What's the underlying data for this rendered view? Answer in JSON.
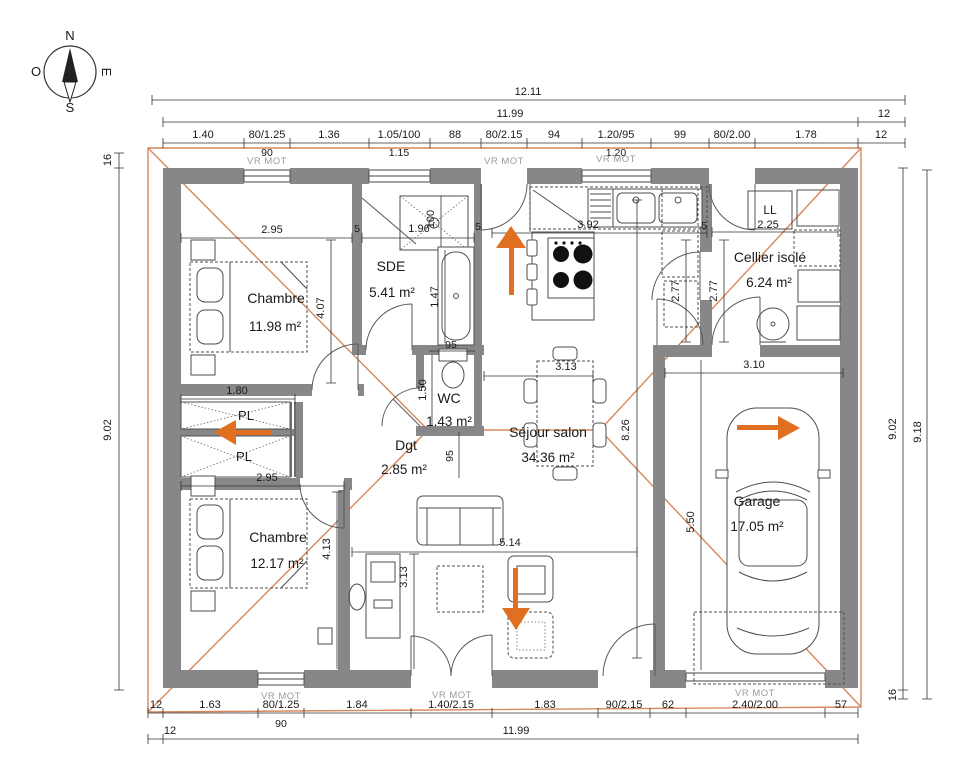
{
  "colors": {
    "wall": "#878787",
    "roof_line": "#D8875C",
    "arrow": "#E0701F",
    "dim_text": "#1a1a1a",
    "shutter_text": "#9b9b9b"
  },
  "compass": {
    "north": "N",
    "south": "S",
    "east": "E",
    "west": "O"
  },
  "top_dims": {
    "total": "12.11",
    "row2_main": "11.99",
    "row2_right": "12",
    "row3": [
      "1.40",
      "80/1.25",
      "1.36",
      "1.05/100",
      "88",
      "80/2.15",
      "94",
      "1.20/95",
      "99",
      "80/2.00",
      "1.78",
      "12"
    ],
    "row4": [
      "90",
      "1.15",
      "1.20"
    ]
  },
  "left_dims": {
    "overhang": "16",
    "height": "9.02"
  },
  "right_dims": {
    "inner": "9.02",
    "outer": "9.18",
    "overhang": "16"
  },
  "bottom_dims": {
    "row1": [
      "12",
      "1.63",
      "80/1.25",
      "1.84",
      "1.40/2.15",
      "1.83",
      "90/2.15",
      "62",
      "2.40/2.00",
      "57"
    ],
    "row1_sub": "90",
    "row2_left": "12",
    "row2_main": "11.99"
  },
  "shutter_labels": [
    "VR MOT",
    "VR MOT",
    "VR MOT",
    "VR MOT",
    "VR MOT",
    "VR MOT"
  ],
  "rooms": {
    "chambre1": {
      "name": "Chambre",
      "area": "11.98 m²"
    },
    "sde": {
      "name": "SDE",
      "area": "5.41 m²"
    },
    "wc": {
      "name": "WC",
      "area": "1.43 m²"
    },
    "dgt": {
      "name": "Dgt",
      "area": "2.85 m²"
    },
    "sejour": {
      "name": "Séjour salon",
      "area": "34.36 m²"
    },
    "cellier": {
      "name": "Cellier isolé",
      "area": "6.24 m²"
    },
    "chambre2": {
      "name": "Chambre",
      "area": "12.17 m²"
    },
    "garage": {
      "name": "Garage",
      "area": "17.05 m²"
    }
  },
  "fixtures": {
    "closet1": "PL",
    "closet2": "PL",
    "washer": "LL"
  },
  "interior_dims": {
    "chambre1_w": "2.95",
    "chambre1_h": "4.07",
    "shower_w": "1.96",
    "shower_d": "100",
    "wall5_a": "5",
    "wall5_b": "5",
    "wall5_c": "5",
    "kitchen_w": "3.92",
    "cellier_d1": "2.77",
    "cellier_d2": "2.77",
    "washer_w": "2.25",
    "bath_l": "1.47",
    "wc_w": "95",
    "wc_h": "1.50",
    "hall_w": "95",
    "table_w": "3.13",
    "sejour_h": "8.26",
    "sejour_w": "5.14",
    "bureau_h": "3.13",
    "chambre2_w": "2.95",
    "chambre2_h": "4.13",
    "pl_w": "1.80",
    "garage_w": "3.10",
    "garage_h": "5.50"
  }
}
